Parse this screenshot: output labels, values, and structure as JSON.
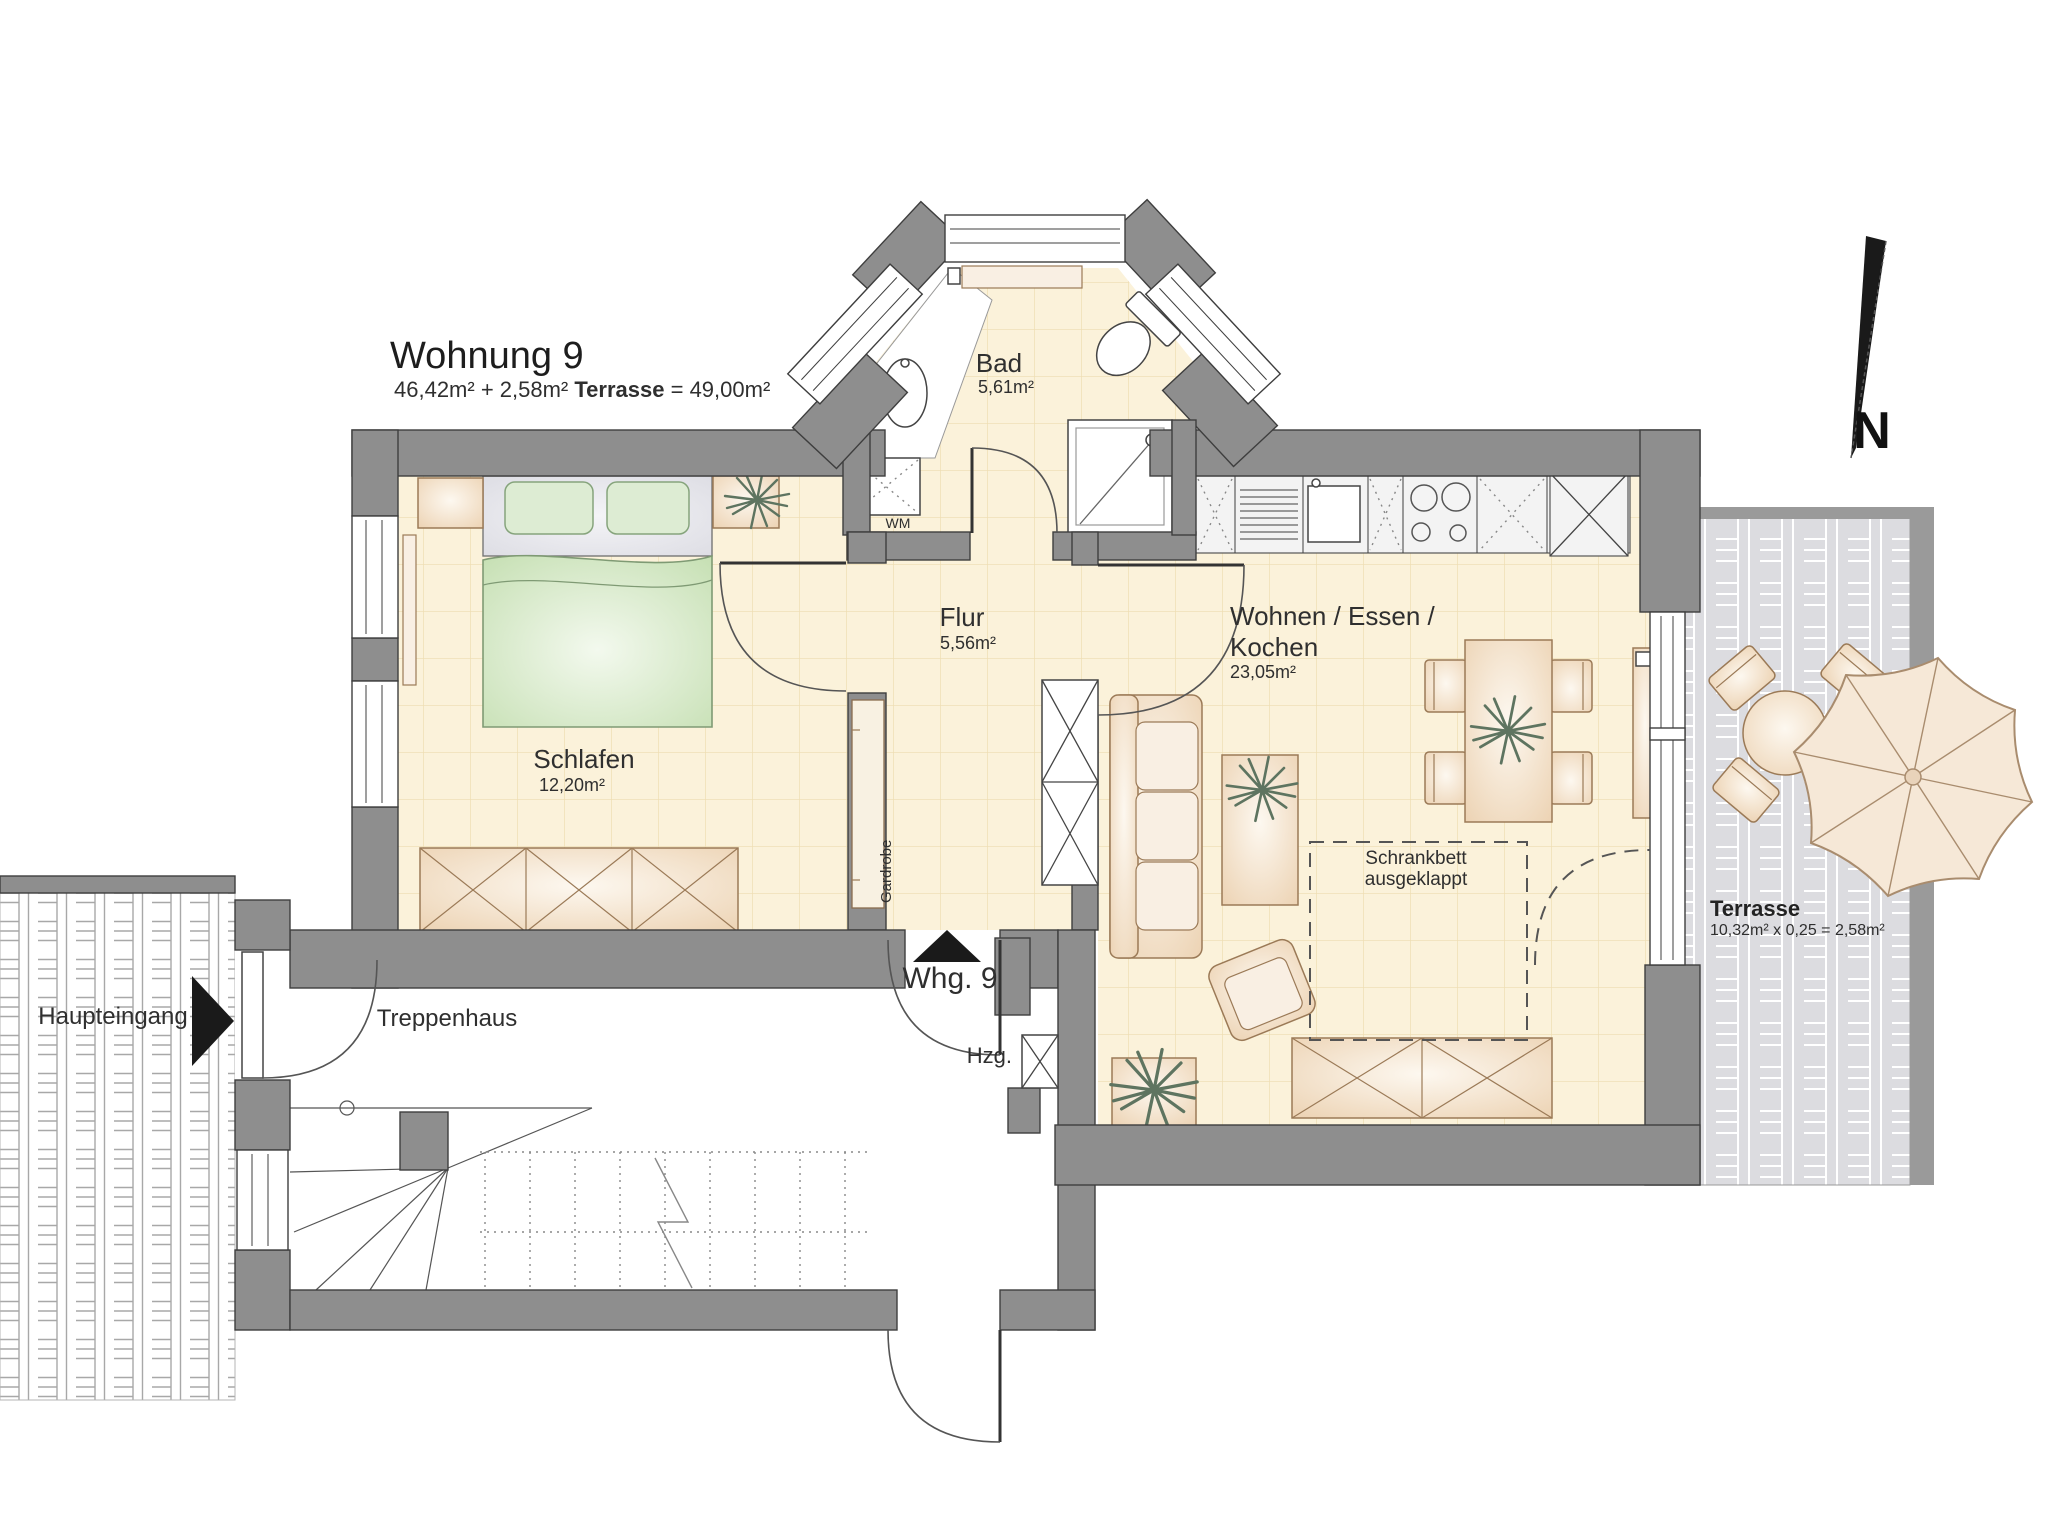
{
  "title": {
    "name": "Wohnung 9",
    "subtitle_a": "46,42m² + 2,58m²",
    "subtitle_b": "Terrasse",
    "subtitle_c": "= 49,00m²"
  },
  "rooms": {
    "bad": {
      "name": "Bad",
      "area": "5,61m²"
    },
    "flur": {
      "name": "Flur",
      "area": "5,56m²"
    },
    "schlafen": {
      "name": "Schlafen",
      "area": "12,20m²"
    },
    "wohnen": {
      "name_line1": "Wohnen / Essen /",
      "name_line2": "Kochen",
      "area": "23,05m²"
    },
    "terrasse": {
      "name": "Terrasse",
      "area_formula": "10,32m² x 0,25 = 2,58m²"
    },
    "treppenhaus": {
      "name": "Treppenhaus"
    }
  },
  "labels": {
    "haupteingang": "Haupteingang",
    "apartment_entrance": "Whg. 9",
    "heizung": "Hzg.",
    "waschmaschine": "WM",
    "garderobe": "Gardrobe",
    "schrankbett_line1": "Schrankbett",
    "schrankbett_line2": "ausgeklappt",
    "north": "N"
  },
  "colors": {
    "wall": "#8e8e8e",
    "wall_outline": "#3e3e3e",
    "floor": "#fbf2da",
    "floor_grid": "#eedcb0",
    "furniture_stroke": "#9b7a57",
    "fixture_outline": "#444444",
    "bed_green": "#cfe4bf",
    "paving_terrace": "#dcdce0",
    "paving_joint": "#ffffff",
    "paving_entrance_joint": "#a8a8a8",
    "text": "#2f2f2f"
  }
}
